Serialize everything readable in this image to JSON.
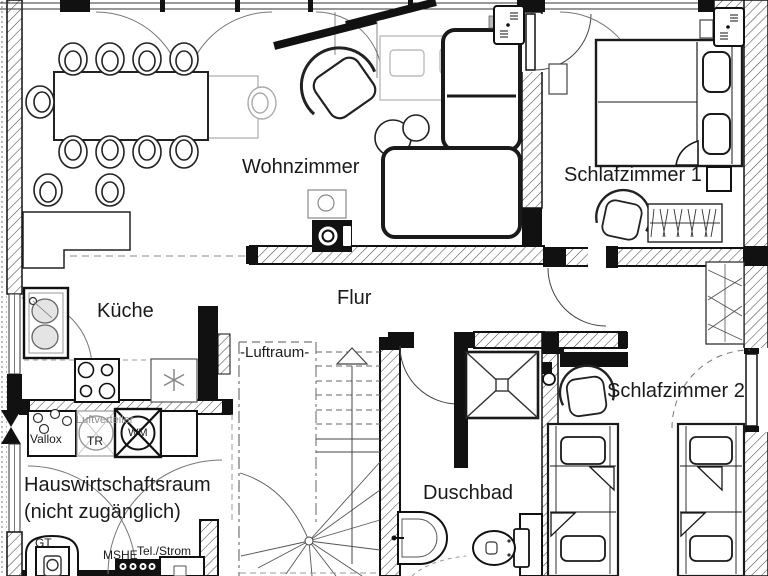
{
  "rooms": [
    {
      "id": "wohnzimmer",
      "label": "Wohnzimmer"
    },
    {
      "id": "schlafzimmer1",
      "label": "Schlafzimmer 1"
    },
    {
      "id": "kueche",
      "label": "Küche"
    },
    {
      "id": "flur",
      "label": "Flur"
    },
    {
      "id": "luftraum",
      "label": "-Luftraum-"
    },
    {
      "id": "duschbad",
      "label": "Duschbad"
    },
    {
      "id": "schlafzimmer2",
      "label": "Schlafzimmer 2"
    },
    {
      "id": "hauswirtschaftsraum",
      "label": "Hauswirtschaftsraum",
      "note": "(nicht zugänglich)"
    }
  ],
  "annotations": [
    {
      "id": "vallox",
      "label": "Vallox"
    },
    {
      "id": "luftverteiler",
      "label": "Luftverteiler"
    },
    {
      "id": "tr",
      "label": "TR"
    },
    {
      "id": "wm",
      "label": "WM"
    },
    {
      "id": "gt",
      "label": "GT"
    },
    {
      "id": "mshe",
      "label": "MSHE"
    },
    {
      "id": "telstrom",
      "label": "Tel./Strom"
    }
  ],
  "colors": {
    "line": "#1a1a1a",
    "ghost_furniture": "#bcbcbc",
    "hatch": "#4a4a4a",
    "background": "#ffffff"
  }
}
